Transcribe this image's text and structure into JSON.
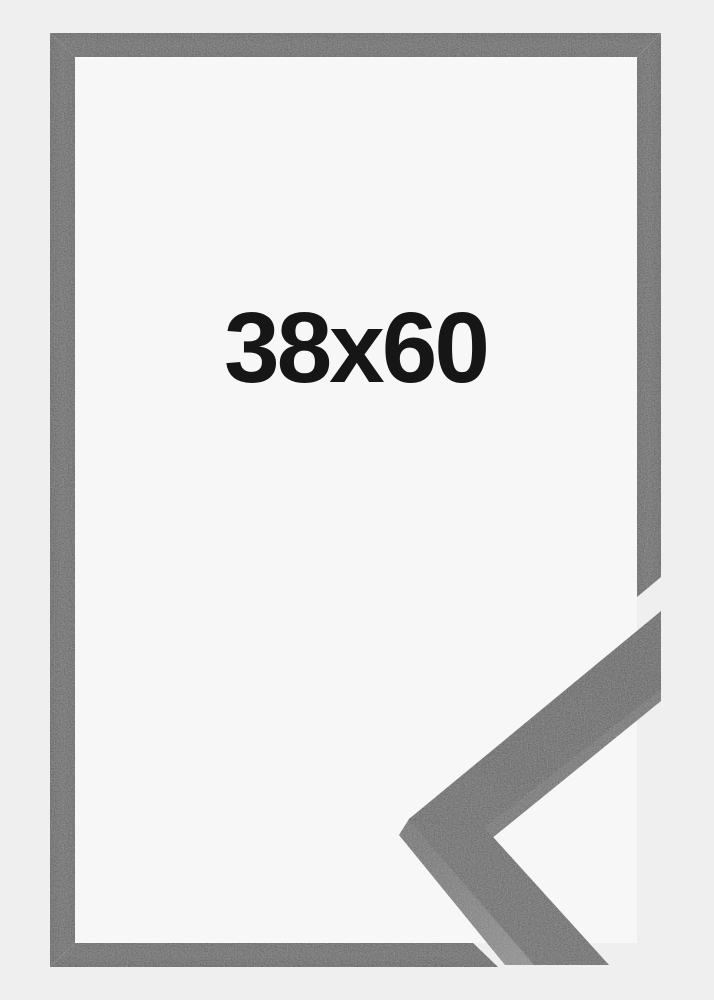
{
  "product": {
    "size_label": "38x60"
  },
  "colors": {
    "background": "#efeff0",
    "inner_background": "#f7f7f7",
    "frame": "#343434",
    "frame_edge_dark": "#2b2b2b",
    "sample_front_face": "#323232",
    "sample_side_face": "#5f5f5f",
    "label_text": "#161616"
  }
}
